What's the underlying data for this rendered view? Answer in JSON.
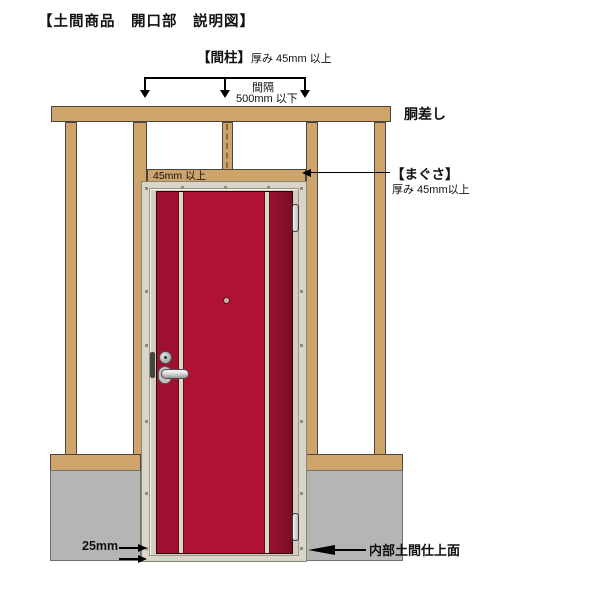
{
  "title": "【土間商品　開口部　説明図】",
  "annotations": {
    "stud": {
      "label": "【間柱】",
      "spec": "厚み 45mm 以上"
    },
    "spacing": {
      "line1": "間隔",
      "line2": "500mm 以下"
    },
    "girder": {
      "label": "胴差し"
    },
    "lintel": {
      "label": "【まぐさ】",
      "spec": "厚み 45mm以上",
      "thickness_text": "45mm 以上"
    },
    "floor_gap": {
      "label": "25mm"
    },
    "interior_floor": {
      "label": "内部土間仕上面"
    }
  },
  "colors": {
    "wood": "#cfa46b",
    "concrete": "#b5b5b5",
    "door_red": "#b01233",
    "door_red_dark": "#780e24",
    "door_stripe": "#ded7c6",
    "frame": "#dad5c9",
    "annotation": "#000000",
    "background": "#ffffff"
  }
}
